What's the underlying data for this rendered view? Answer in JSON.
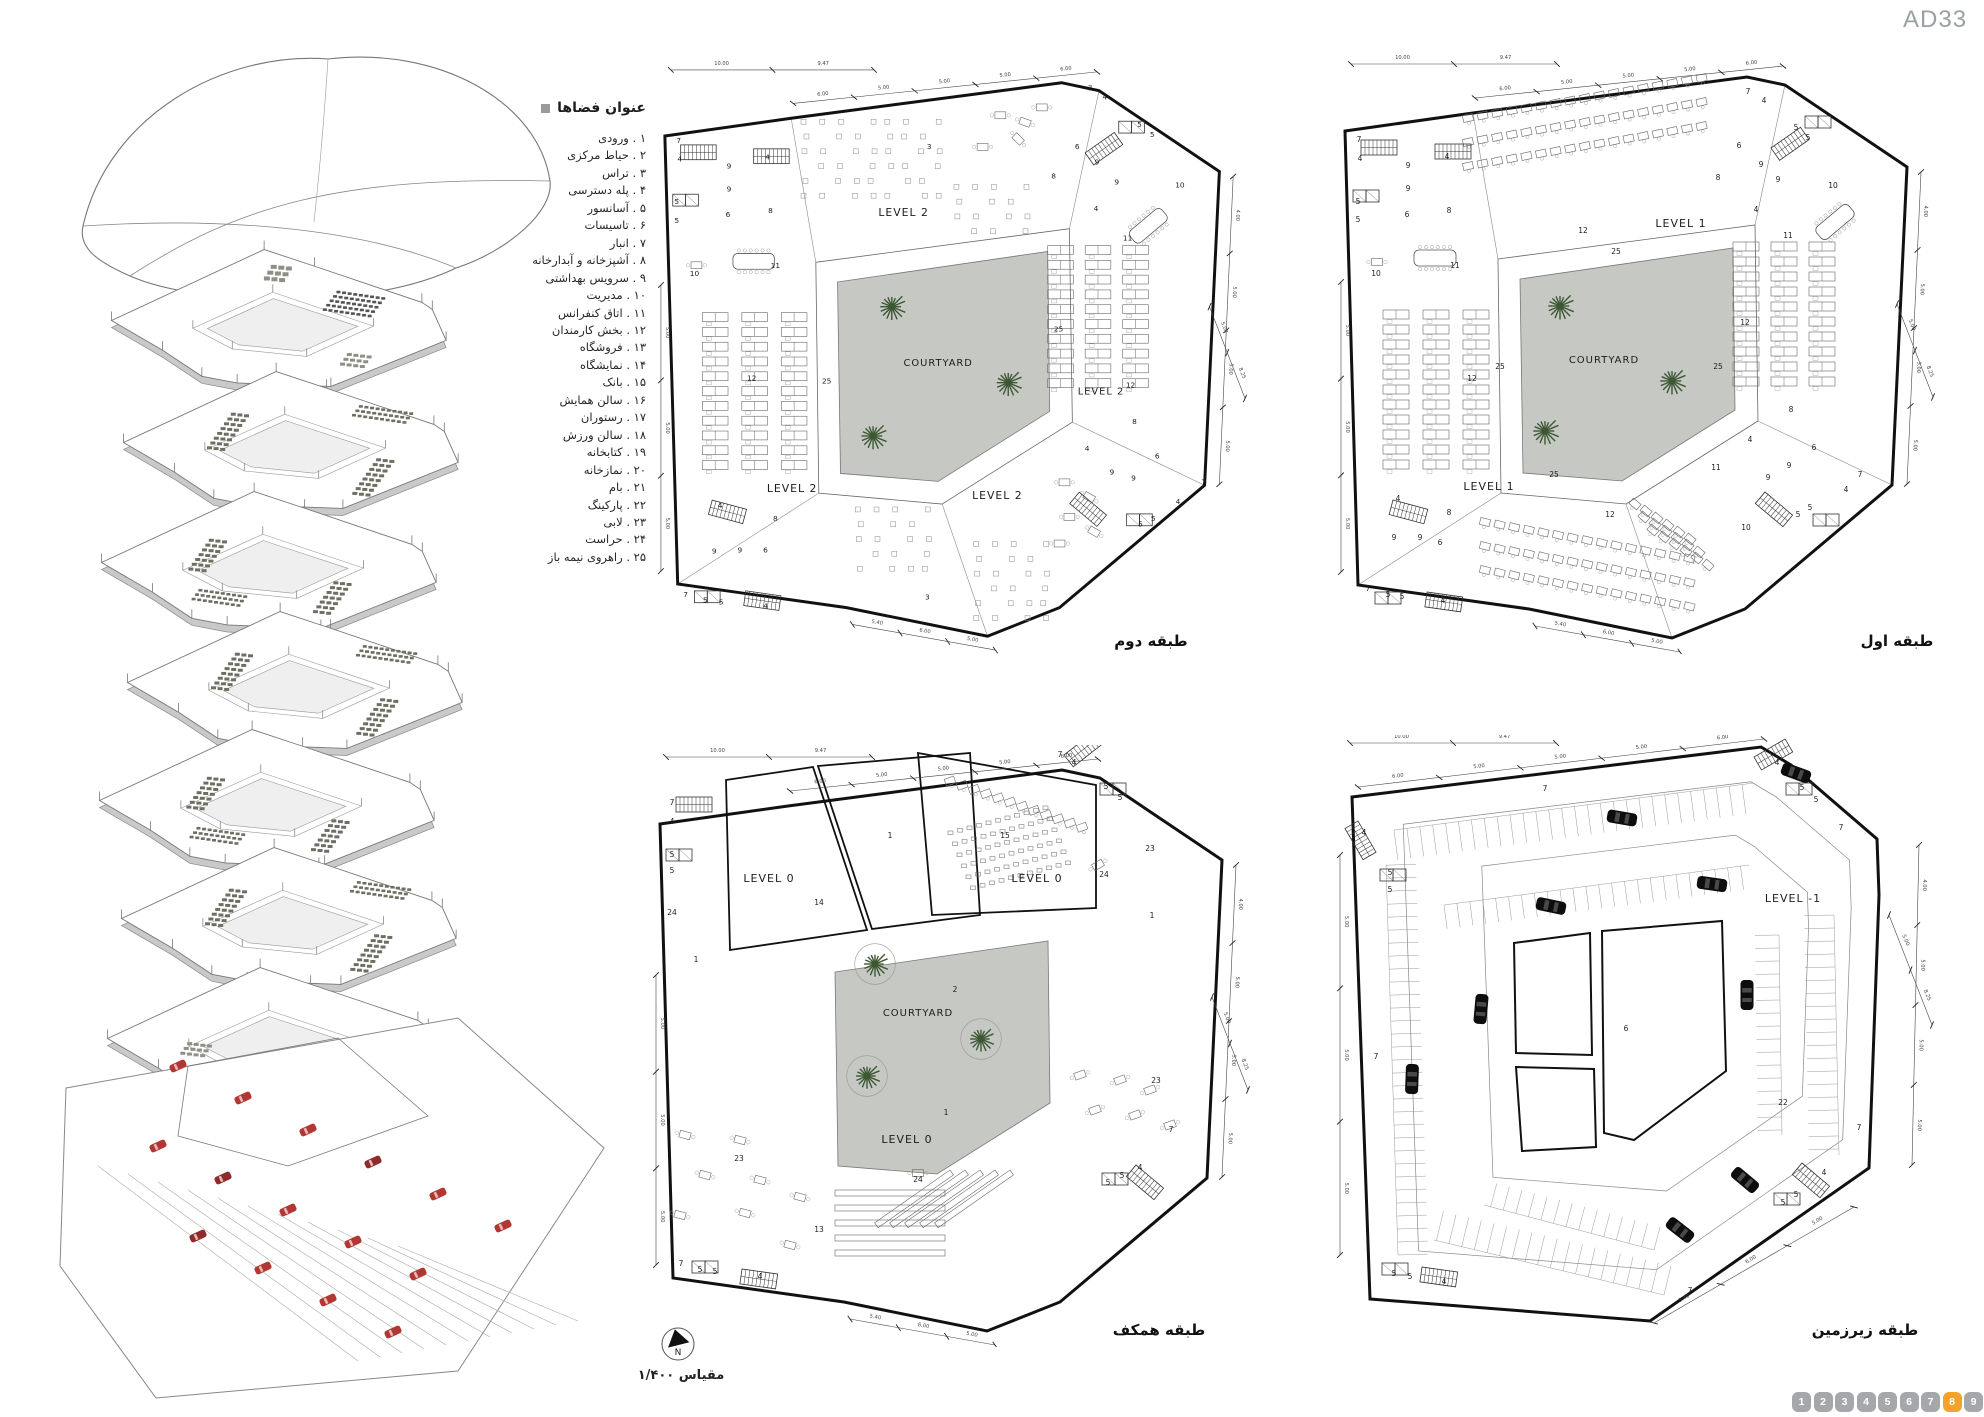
{
  "page": {
    "code": "AD33"
  },
  "colors": {
    "line": "#111111",
    "thin": "#666666",
    "courtyard_fill": "#c6c8c4",
    "tree_green": "#3c5733",
    "car_black": "#0d0d0d",
    "car_red": "#b23632",
    "pager_gray": "#a5a7aa",
    "pager_active": "#f3a32a",
    "muted_text": "#9aa0a4"
  },
  "legend": {
    "title": "عنوان فضاها",
    "items": [
      {
        "num": "۱",
        "label": "ورودی"
      },
      {
        "num": "۲",
        "label": "حیاط مرکزی"
      },
      {
        "num": "۳",
        "label": "تراس"
      },
      {
        "num": "۴",
        "label": "پله دسترسی"
      },
      {
        "num": "۵",
        "label": "آسانسور"
      },
      {
        "num": "۶",
        "label": "تاسیسات"
      },
      {
        "num": "۷",
        "label": "انبار"
      },
      {
        "num": "۸",
        "label": "آشپزخانه و آبدارخانه"
      },
      {
        "num": "۹",
        "label": "سرویس بهداشتی"
      },
      {
        "num": "۱۰",
        "label": "مدیریت"
      },
      {
        "num": "۱۱",
        "label": "اتاق کنفرانس"
      },
      {
        "num": "۱۲",
        "label": "بخش کارمندان"
      },
      {
        "num": "۱۳",
        "label": "فروشگاه"
      },
      {
        "num": "۱۴",
        "label": "نمایشگاه"
      },
      {
        "num": "۱۵",
        "label": "بانک"
      },
      {
        "num": "۱۶",
        "label": "سالن همایش"
      },
      {
        "num": "۱۷",
        "label": "رستوران"
      },
      {
        "num": "۱۸",
        "label": "سالن ورزش"
      },
      {
        "num": "۱۹",
        "label": "کتابخانه"
      },
      {
        "num": "۲۰",
        "label": "نمازخانه"
      },
      {
        "num": "۲۱",
        "label": "بام"
      },
      {
        "num": "۲۲",
        "label": "پارکینگ"
      },
      {
        "num": "۲۳",
        "label": "لابی"
      },
      {
        "num": "۲۴",
        "label": "حراست"
      },
      {
        "num": "۲۵",
        "label": "راهروی نیمه باز"
      }
    ]
  },
  "dims": {
    "top_h": [
      "10.00",
      "9.47"
    ],
    "top_s": [
      "6.00",
      "5.00",
      "5.00",
      "5.00",
      "6.00"
    ],
    "right": [
      "4.00",
      "5.00",
      "5.00",
      "5.00"
    ],
    "bottom": [
      "5.40",
      "6.00",
      "5.00"
    ],
    "left": [
      "5.00",
      "5.00",
      "5.00"
    ],
    "leader": [
      "5.00",
      "8.25"
    ]
  },
  "plans": {
    "second": {
      "title": "طبقه دوم",
      "labels": [
        [
          "LEVEL 2",
          252,
          160,
          11
        ],
        [
          "LEVEL 2",
          452,
          341,
          10
        ],
        [
          "LEVEL 2",
          139,
          440,
          11
        ],
        [
          "LEVEL 2",
          347,
          447,
          11
        ],
        [
          "COURTYARD",
          287,
          312,
          10
        ],
        [
          "25",
          174,
          330
        ],
        [
          "25",
          409,
          277
        ],
        [
          "3",
          278,
          92
        ],
        [
          "3",
          276,
          549
        ],
        [
          "7",
          24,
          86
        ],
        [
          "4",
          25,
          105
        ],
        [
          "9",
          75,
          112
        ],
        [
          "4",
          114,
          103
        ],
        [
          "9",
          75,
          135
        ],
        [
          "8",
          117,
          157
        ],
        [
          "6",
          74,
          161
        ],
        [
          "5",
          22,
          148
        ],
        [
          "5",
          22,
          167
        ],
        [
          "10",
          40,
          221
        ],
        [
          "11",
          122,
          213
        ],
        [
          "12",
          98,
          327
        ],
        [
          "4",
          66,
          456
        ],
        [
          "8",
          122,
          469
        ],
        [
          "9",
          60,
          502
        ],
        [
          "9",
          86,
          501
        ],
        [
          "6",
          112,
          501
        ],
        [
          "7",
          31,
          546
        ],
        [
          "5",
          51,
          552
        ],
        [
          "5",
          67,
          554
        ],
        [
          "4",
          112,
          558
        ],
        [
          "7",
          441,
          33
        ],
        [
          "4",
          456,
          42
        ],
        [
          "5",
          491,
          70
        ],
        [
          "5",
          504,
          80
        ],
        [
          "6",
          428,
          92
        ],
        [
          "9",
          448,
          108
        ],
        [
          "8",
          404,
          122
        ],
        [
          "9",
          468,
          128
        ],
        [
          "4",
          447,
          155
        ],
        [
          "10",
          532,
          131
        ],
        [
          "11",
          479,
          185
        ],
        [
          "12",
          482,
          334
        ],
        [
          "8",
          486,
          371
        ],
        [
          "4",
          438,
          398
        ],
        [
          "6",
          509,
          406
        ],
        [
          "9",
          463,
          422
        ],
        [
          "9",
          485,
          428
        ],
        [
          "7",
          556,
          432
        ],
        [
          "5",
          492,
          475
        ],
        [
          "5",
          505,
          469
        ],
        [
          "4",
          530,
          452
        ]
      ]
    },
    "first": {
      "title": "طبقه اول",
      "labels": [
        [
          "LEVEL 1",
          346,
          175,
          11
        ],
        [
          "LEVEL 1",
          154,
          438,
          11
        ],
        [
          "COURTYARD",
          269,
          311,
          10
        ],
        [
          "25",
          281,
          202
        ],
        [
          "25",
          165,
          317
        ],
        [
          "25",
          383,
          317
        ],
        [
          "25",
          219,
          425
        ],
        [
          "12",
          248,
          181
        ],
        [
          "12",
          137,
          329
        ],
        [
          "12",
          410,
          273
        ],
        [
          "12",
          275,
          465
        ],
        [
          "7",
          24,
          90
        ],
        [
          "4",
          25,
          109
        ],
        [
          "9",
          73,
          116
        ],
        [
          "4",
          112,
          107
        ],
        [
          "9",
          73,
          139
        ],
        [
          "8",
          114,
          161
        ],
        [
          "6",
          72,
          165
        ],
        [
          "5",
          23,
          152
        ],
        [
          "5",
          23,
          170
        ],
        [
          "10",
          41,
          224
        ],
        [
          "11",
          120,
          216
        ],
        [
          "4",
          63,
          449
        ],
        [
          "8",
          114,
          463
        ],
        [
          "9",
          59,
          488
        ],
        [
          "9",
          85,
          488
        ],
        [
          "6",
          105,
          493
        ],
        [
          "7",
          33,
          539
        ],
        [
          "5",
          53,
          545
        ],
        [
          "5",
          67,
          547
        ],
        [
          "4",
          108,
          551
        ],
        [
          "7",
          413,
          42
        ],
        [
          "4",
          429,
          51
        ],
        [
          "5",
          461,
          78
        ],
        [
          "5",
          473,
          88
        ],
        [
          "6",
          404,
          96
        ],
        [
          "9",
          426,
          115
        ],
        [
          "8",
          383,
          128
        ],
        [
          "9",
          443,
          130
        ],
        [
          "4",
          421,
          160
        ],
        [
          "10",
          498,
          136
        ],
        [
          "11",
          453,
          186
        ],
        [
          "8",
          456,
          360
        ],
        [
          "4",
          415,
          390
        ],
        [
          "6",
          479,
          398
        ],
        [
          "9",
          454,
          416
        ],
        [
          "9",
          433,
          428
        ],
        [
          "11",
          381,
          418
        ],
        [
          "10",
          411,
          478
        ],
        [
          "7",
          525,
          425
        ],
        [
          "5",
          463,
          465
        ],
        [
          "5",
          475,
          458
        ],
        [
          "4",
          511,
          440
        ]
      ]
    },
    "ground": {
      "title": "طبقه همکف",
      "labels": [
        [
          "LEVEL 0",
          119,
          137,
          11
        ],
        [
          "LEVEL 0",
          387,
          137,
          11
        ],
        [
          "LEVEL 0",
          257,
          398,
          11
        ],
        [
          "COURTYARD",
          268,
          271,
          10
        ],
        [
          "1",
          240,
          93
        ],
        [
          "15",
          355,
          93
        ],
        [
          "23",
          500,
          106
        ],
        [
          "24",
          454,
          132
        ],
        [
          "1",
          502,
          173
        ],
        [
          "1",
          46,
          217
        ],
        [
          "2",
          305,
          247
        ],
        [
          "1",
          296,
          370
        ],
        [
          "23",
          506,
          338
        ],
        [
          "23",
          89,
          416
        ],
        [
          "24",
          268,
          437
        ],
        [
          "13",
          169,
          487
        ],
        [
          "14",
          169,
          160
        ],
        [
          "7",
          22,
          60
        ],
        [
          "4",
          22,
          79
        ],
        [
          "5",
          22,
          112
        ],
        [
          "5",
          22,
          128
        ],
        [
          "24",
          22,
          170
        ],
        [
          "7",
          410,
          12
        ],
        [
          "4",
          424,
          20
        ],
        [
          "5",
          456,
          44
        ],
        [
          "5",
          470,
          55
        ],
        [
          "7",
          31,
          521
        ],
        [
          "5",
          50,
          527
        ],
        [
          "5",
          65,
          529
        ],
        [
          "4",
          110,
          534
        ],
        [
          "7",
          521,
          387
        ],
        [
          "4",
          490,
          425
        ],
        [
          "5",
          458,
          440
        ],
        [
          "5",
          472,
          433
        ]
      ]
    },
    "basement": {
      "title": "طبقه زیرزمین",
      "labels": [
        [
          "LEVEL -1",
          459,
          167,
          11
        ],
        [
          "7",
          211,
          56
        ],
        [
          "7",
          42,
          324
        ],
        [
          "7",
          507,
          95
        ],
        [
          "7",
          525,
          395
        ],
        [
          "7",
          356,
          558
        ],
        [
          "22",
          449,
          370
        ],
        [
          "6",
          292,
          296
        ],
        [
          "4",
          443,
          30
        ],
        [
          "5",
          468,
          55
        ],
        [
          "5",
          482,
          67
        ],
        [
          "4",
          30,
          100
        ],
        [
          "5",
          56,
          140
        ],
        [
          "5",
          56,
          157
        ],
        [
          "5",
          60,
          541
        ],
        [
          "5",
          76,
          544
        ],
        [
          "4",
          110,
          549
        ],
        [
          "5",
          449,
          470
        ],
        [
          "5",
          462,
          462
        ],
        [
          "4",
          490,
          440
        ]
      ]
    }
  },
  "compass": {
    "letter": "N"
  },
  "scale_note": "مقیاس  ۱/۴۰۰",
  "pagination": {
    "pages": [
      "1",
      "2",
      "3",
      "4",
      "5",
      "6",
      "7",
      "8",
      "9"
    ],
    "active_index": 7
  }
}
